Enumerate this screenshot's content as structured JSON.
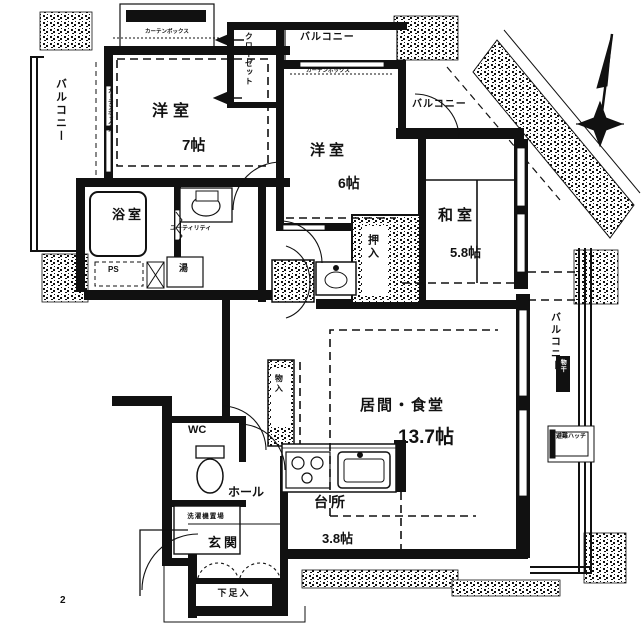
{
  "page": {
    "number": "2"
  },
  "rooms": {
    "yoshitsu7": {
      "name": "洋室",
      "size": "7帖"
    },
    "yoshitsu6": {
      "name": "洋室",
      "size": "6帖"
    },
    "washitsu": {
      "name": "和室",
      "size": "5.8帖"
    },
    "living": {
      "name": "居間・食堂",
      "size": "13.7帖"
    },
    "kitchen": {
      "name": "台所",
      "size": "3.8帖"
    },
    "bath": {
      "name": "浴室"
    },
    "utility": {
      "name": "ユーティリティ"
    },
    "wc": {
      "name": "WC"
    },
    "hall": {
      "name": "ホール"
    },
    "entrance": {
      "name": "玄関"
    },
    "shoe_box": {
      "name": "下足入"
    },
    "laundry": {
      "name": "洗濯機置場"
    }
  },
  "balconies": {
    "left": "バルコニー",
    "top": "バルコニー",
    "upper_right": "バルコニー",
    "right": "バルコニー"
  },
  "storage": {
    "closet": "クローゼット",
    "oshiire": "押入",
    "monoire": "物入"
  },
  "labels": {
    "ps": "PS",
    "water_heater": "湯",
    "curtain_box_1": "カーテンボックス",
    "curtain_box_2": "カーテンボックス",
    "curtain_box_3": "カーテンボックス",
    "monohoshi": "物干",
    "escape_hatch": "避難ハッチ"
  },
  "colors": {
    "ink": "#111111",
    "paper": "#ffffff"
  }
}
